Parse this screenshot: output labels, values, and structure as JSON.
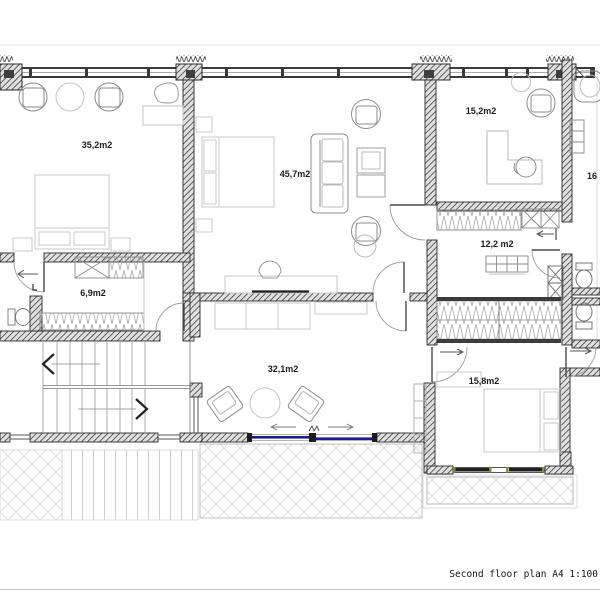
{
  "plan": {
    "title": "Second floor plan A4 1:100",
    "rooms": [
      {
        "id": "bedroom-master",
        "label": "35,2m2"
      },
      {
        "id": "suite-living",
        "label": "45,7m2"
      },
      {
        "id": "office",
        "label": "15,2m2"
      },
      {
        "id": "bath-right",
        "label": "16"
      },
      {
        "id": "walk-in-closet",
        "label": "12,2 m2"
      },
      {
        "id": "closet",
        "label": "6,9m2"
      },
      {
        "id": "lounge",
        "label": "32,1m2"
      },
      {
        "id": "bedroom-2",
        "label": "15,8m2"
      }
    ]
  }
}
